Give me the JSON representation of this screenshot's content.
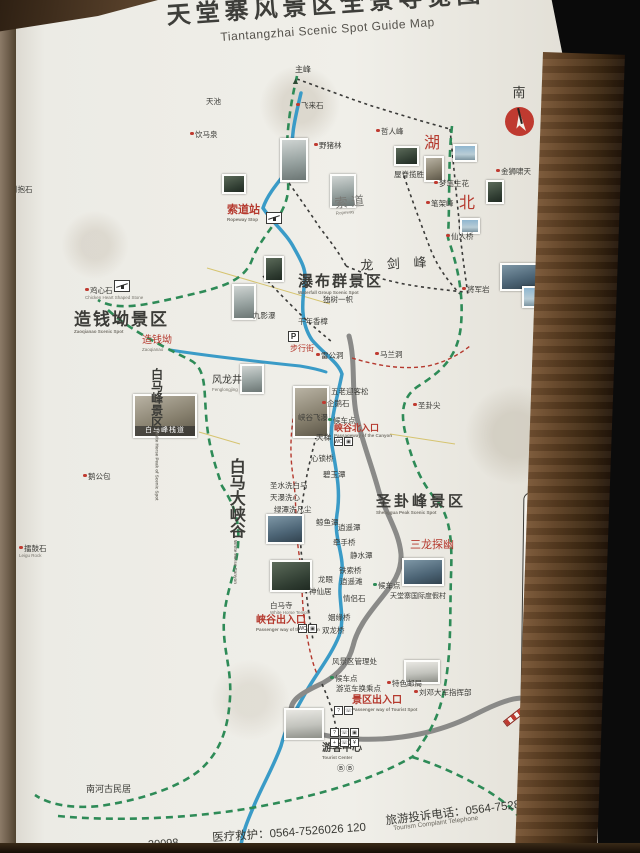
{
  "title": {
    "cn": "天堂寨风景区全景导览图",
    "en": "Tiantangzhai Scenic Spot Guide Map"
  },
  "compass": {
    "label": "南"
  },
  "footer": {
    "fragment": "20098",
    "medical": "医疗救护：0564-7526026 120",
    "complaint_cn": "旅游投诉电话：0564-7528013",
    "complaint_en": "Tourism Complaint Telephone"
  },
  "colors": {
    "boundary": "#2e8b57",
    "river": "#3a9bc7",
    "road": "#8a8a88",
    "red": "#b5392e"
  },
  "legend": {
    "title": "图例",
    "items": [
      {
        "g": "◉",
        "c": "#bf3a30",
        "t": "主要景点"
      },
      {
        "g": "●",
        "c": "#bf3a30",
        "t": "景点"
      },
      {
        "g": "→",
        "box": 1,
        "t": "入口"
      },
      {
        "g": "←",
        "box": 1,
        "t": "出口"
      },
      {
        "g": "?",
        "box": 1,
        "t": "游客服务中心"
      },
      {
        "g": "¥",
        "box": 1,
        "t": "售票处"
      },
      {
        "g": "▣",
        "box": 1,
        "t": "观景台"
      },
      {
        "g": "WC",
        "box": 1,
        "t": "卫生间"
      },
      {
        "g": "☏",
        "box": 1,
        "t": "公用电话"
      },
      {
        "g": "+",
        "c": "#bf3a30",
        "t": "医疗点"
      },
      {
        "g": "♨",
        "box": 1,
        "t": "餐饮店"
      },
      {
        "g": "▥",
        "box": 1,
        "t": "商店"
      },
      {
        "g": "B",
        "box": 1,
        "t": "大型游览车乘车点"
      },
      {
        "g": "b",
        "box": 1,
        "t": "小型游览车乘车点"
      },
      {
        "g": "◈",
        "box": 1,
        "t": "购物中心"
      },
      {
        "g": "✉",
        "box": 1,
        "t": "邮政所"
      },
      {
        "g": "⊘",
        "c": "#bf3a30",
        "t": "禁止吸烟"
      },
      {
        "g": "⊘",
        "c": "#bf3a30",
        "t": "禁止游泳"
      },
      {
        "g": "索",
        "box": 1,
        "t": "索道"
      },
      {
        "g": "●",
        "c": "#2e8b57",
        "t": "候车点"
      },
      {
        "g": "卍",
        "c": "#3a3a36",
        "t": "寺庙"
      },
      {
        "g": "▲",
        "c": "#3a3a36",
        "t": "海拔标高"
      },
      {
        "line": "road",
        "t": "公路"
      },
      {
        "line": "river",
        "t": "河流"
      },
      {
        "line": "trail",
        "t": "步道"
      },
      {
        "line": "path",
        "t": "游步道"
      },
      {
        "line": "border",
        "t": "景区界线"
      }
    ]
  },
  "map": {
    "region_labels": [
      {
        "t": "湖",
        "x": 424,
        "y": 136,
        "fs": 16,
        "c": "red"
      },
      {
        "t": "北",
        "x": 459,
        "y": 196,
        "fs": 16,
        "c": "red"
      },
      {
        "t": "索道站",
        "x": 227,
        "y": 205,
        "fs": 11,
        "c": "red",
        "en": "Ropeway Stop",
        "b": 1
      },
      {
        "t": "索 道",
        "x": 334,
        "y": 197,
        "fs": 13,
        "c": "dim",
        "en": "Ropeway",
        "rot": -6
      },
      {
        "t": "龙 剑 峰",
        "x": 360,
        "y": 259,
        "fs": 13,
        "ls": 5,
        "rot": -3
      },
      {
        "t": "瀑布群景区",
        "x": 298,
        "y": 274,
        "fs": 15,
        "ls": 2,
        "en": "Waterfall Group Scenic Spot",
        "b": 1
      },
      {
        "t": "造钱坳景区",
        "x": 74,
        "y": 311,
        "fs": 17,
        "ls": 2,
        "en": "Zaoqianao Scenic Spot",
        "b": 1
      },
      {
        "t": "造钱坳",
        "x": 142,
        "y": 336,
        "fs": 10,
        "c": "red",
        "en": "Zaoqianao"
      },
      {
        "t": "白马峰景区",
        "x": 150,
        "y": 368,
        "fs": 12,
        "v": 1,
        "en": "White Horse Peak of Scenic Spot",
        "b": 1
      },
      {
        "t": "白马大峡谷",
        "x": 226,
        "y": 458,
        "fs": 16,
        "v": 1,
        "en": "White Horse Canyon",
        "b": 1
      },
      {
        "t": "圣卦峰景区",
        "x": 376,
        "y": 494,
        "fs": 15,
        "ls": 3,
        "en": "Shenggua Peak Scenic Spot",
        "b": 1
      },
      {
        "t": "三龙探幽",
        "x": 410,
        "y": 540,
        "fs": 11,
        "c": "red"
      },
      {
        "t": "峡谷北入口",
        "x": 334,
        "y": 424,
        "fs": 9,
        "c": "red",
        "en": "Passageway of the Canyon",
        "b": 1
      },
      {
        "t": "峡谷出入口",
        "x": 256,
        "y": 616,
        "fs": 10,
        "c": "red",
        "en": "Passenger way of the Canyon",
        "b": 1
      },
      {
        "t": "景区出入口",
        "x": 352,
        "y": 696,
        "fs": 10,
        "c": "red",
        "en": "Passenger way of Tourist Spot",
        "b": 1
      },
      {
        "t": "游客中心",
        "x": 322,
        "y": 744,
        "fs": 10,
        "en": "Tourist Center",
        "b": 1
      },
      {
        "t": "出景区方向",
        "x": 530,
        "y": 722,
        "fs": 11,
        "c": "red",
        "rot": -52,
        "ls": 2
      },
      {
        "t": "南河古民居",
        "x": 86,
        "y": 785,
        "fs": 9
      },
      {
        "t": "风龙井",
        "x": 212,
        "y": 376,
        "fs": 10,
        "en": "Fenglongjing"
      },
      {
        "t": "步行街",
        "x": 290,
        "y": 345,
        "fs": 8,
        "c": "red"
      },
      {
        "t": "天堂寨国际度假村",
        "x": 390,
        "y": 593,
        "fs": 7
      },
      {
        "t": "主峰",
        "x": 295,
        "y": 66,
        "fs": 8
      }
    ],
    "spots": [
      {
        "t": "天池",
        "x": 206,
        "y": 98
      },
      {
        "t": "饮马泉",
        "x": 190,
        "y": 131,
        "d": "r"
      },
      {
        "t": "倒抱石",
        "x": 5,
        "y": 186,
        "d": "r"
      },
      {
        "t": "鸡心石",
        "x": 85,
        "y": 287,
        "d": "r",
        "en": "Chicken Heart Shaped Stone"
      },
      {
        "t": "鹅公包",
        "x": 83,
        "y": 473,
        "d": "r"
      },
      {
        "t": "擂鼓石",
        "x": 19,
        "y": 545,
        "d": "r",
        "en": "Leigu Rock"
      },
      {
        "t": "飞来石",
        "x": 296,
        "y": 102,
        "d": "r"
      },
      {
        "t": "野猪林",
        "x": 314,
        "y": 142,
        "d": "r"
      },
      {
        "t": "哲人峰",
        "x": 376,
        "y": 128,
        "d": "r"
      },
      {
        "t": "屋脊揽胜",
        "x": 394,
        "y": 171
      },
      {
        "t": "梦笔生花",
        "x": 434,
        "y": 180,
        "d": "r"
      },
      {
        "t": "金狮啸天",
        "x": 496,
        "y": 168,
        "d": "r"
      },
      {
        "t": "笔架峰",
        "x": 426,
        "y": 200,
        "d": "r"
      },
      {
        "t": "仙人桥",
        "x": 446,
        "y": 233,
        "d": "r"
      },
      {
        "t": "将军岩",
        "x": 462,
        "y": 286,
        "d": "r"
      },
      {
        "t": "九影瀑",
        "x": 253,
        "y": 312
      },
      {
        "t": "独树一帜",
        "x": 323,
        "y": 296
      },
      {
        "t": "千年香樟",
        "x": 298,
        "y": 318
      },
      {
        "t": "雷公洞",
        "x": 316,
        "y": 352,
        "d": "r"
      },
      {
        "t": "马兰洞",
        "x": 375,
        "y": 351,
        "d": "r"
      },
      {
        "t": "五老迎客松",
        "x": 331,
        "y": 388
      },
      {
        "t": "企鹅石",
        "x": 322,
        "y": 400,
        "d": "r"
      },
      {
        "t": "圣卦尖",
        "x": 413,
        "y": 402,
        "d": "r"
      },
      {
        "t": "候车点",
        "x": 328,
        "y": 417,
        "d": "g"
      },
      {
        "t": "峡谷飞瀑",
        "x": 298,
        "y": 414
      },
      {
        "t": "天梯",
        "x": 316,
        "y": 434
      },
      {
        "t": "心锁桥",
        "x": 311,
        "y": 455
      },
      {
        "t": "碧玉潭",
        "x": 323,
        "y": 471
      },
      {
        "t": "圣水洗白马",
        "x": 270,
        "y": 482
      },
      {
        "t": "天瀑洗心",
        "x": 270,
        "y": 494
      },
      {
        "t": "绿潭洗凡尘",
        "x": 274,
        "y": 506
      },
      {
        "t": "鲸鱼潭",
        "x": 316,
        "y": 519
      },
      {
        "t": "逍遥潭",
        "x": 338,
        "y": 524
      },
      {
        "t": "牵手桥",
        "x": 333,
        "y": 539
      },
      {
        "t": "静水潭",
        "x": 350,
        "y": 552
      },
      {
        "t": "铁索桥",
        "x": 339,
        "y": 567
      },
      {
        "t": "龙眼",
        "x": 318,
        "y": 576
      },
      {
        "t": "逍遥滩",
        "x": 340,
        "y": 578
      },
      {
        "t": "神仙居",
        "x": 309,
        "y": 588
      },
      {
        "t": "情侣石",
        "x": 343,
        "y": 595
      },
      {
        "t": "姻缘桥",
        "x": 328,
        "y": 614
      },
      {
        "t": "双龙桥",
        "x": 322,
        "y": 627
      },
      {
        "t": "白马寺",
        "x": 270,
        "y": 602,
        "en": "White Horse Temple"
      },
      {
        "t": "候车点",
        "x": 373,
        "y": 582,
        "d": "g"
      },
      {
        "t": "风景区管理处",
        "x": 332,
        "y": 658
      },
      {
        "t": "候车点",
        "x": 330,
        "y": 675,
        "d": "g"
      },
      {
        "t": "游览车换乘点",
        "x": 336,
        "y": 685
      },
      {
        "t": "特色邮局",
        "x": 387,
        "y": 680,
        "d": "r"
      },
      {
        "t": "刘邓大军指挥部",
        "x": 414,
        "y": 689,
        "d": "r"
      }
    ],
    "photos": [
      {
        "x": 280,
        "y": 138,
        "w": 28,
        "h": 44,
        "tone": "mist"
      },
      {
        "x": 222,
        "y": 174,
        "w": 24,
        "h": 20,
        "tone": "forest"
      },
      {
        "x": 330,
        "y": 174,
        "w": 26,
        "h": 34,
        "tone": "mist"
      },
      {
        "x": 394,
        "y": 146,
        "w": 25,
        "h": 20,
        "tone": "forest"
      },
      {
        "x": 424,
        "y": 156,
        "w": 20,
        "h": 26,
        "tone": "rock"
      },
      {
        "x": 453,
        "y": 144,
        "w": 24,
        "h": 18,
        "tone": "sky"
      },
      {
        "x": 486,
        "y": 180,
        "w": 18,
        "h": 24,
        "tone": "forest"
      },
      {
        "x": 460,
        "y": 218,
        "w": 20,
        "h": 16,
        "tone": "sky"
      },
      {
        "x": 500,
        "y": 263,
        "w": 38,
        "h": 28,
        "tone": "water"
      },
      {
        "x": 522,
        "y": 286,
        "w": 30,
        "h": 22,
        "tone": "sky"
      },
      {
        "x": 232,
        "y": 284,
        "w": 24,
        "h": 36,
        "tone": "mist"
      },
      {
        "x": 264,
        "y": 256,
        "w": 20,
        "h": 26,
        "tone": "forest"
      },
      {
        "x": 240,
        "y": 364,
        "w": 24,
        "h": 30,
        "tone": "mist"
      },
      {
        "x": 133,
        "y": 394,
        "w": 64,
        "h": 44,
        "tone": "rock",
        "cap": "白马峰栈道"
      },
      {
        "x": 293,
        "y": 386,
        "w": 36,
        "h": 52,
        "tone": "rock"
      },
      {
        "x": 266,
        "y": 514,
        "w": 38,
        "h": 30,
        "tone": "water"
      },
      {
        "x": 270,
        "y": 560,
        "w": 42,
        "h": 32,
        "tone": "forest"
      },
      {
        "x": 402,
        "y": 558,
        "w": 42,
        "h": 28,
        "tone": "water"
      },
      {
        "x": 404,
        "y": 660,
        "w": 36,
        "h": 24,
        "tone": "bright"
      },
      {
        "x": 284,
        "y": 708,
        "w": 40,
        "h": 32,
        "tone": "bright"
      }
    ],
    "icons": [
      {
        "k": "peak",
        "x": 291,
        "y": 76
      },
      {
        "k": "cable",
        "x": 266,
        "y": 212
      },
      {
        "k": "cable",
        "x": 114,
        "y": 268
      },
      {
        "k": "pbox",
        "x": 288,
        "y": 331
      },
      {
        "k": "boxes",
        "x": 334,
        "y": 437,
        "g": [
          "WC",
          "▣"
        ]
      },
      {
        "k": "boxes",
        "x": 298,
        "y": 624,
        "g": [
          "WC",
          "▣"
        ]
      },
      {
        "k": "boxes",
        "x": 334,
        "y": 706,
        "g": [
          "?",
          "☏"
        ]
      },
      {
        "k": "grid",
        "x": 330,
        "y": 728,
        "g": [
          "?",
          "☏",
          "▣",
          "+",
          "☏",
          "¥"
        ]
      },
      {
        "k": "bb",
        "x": 337,
        "y": 763,
        "g": [
          "Ⓑ",
          "Ⓑ"
        ]
      },
      {
        "k": "barrier",
        "x": 502,
        "y": 712
      }
    ]
  }
}
